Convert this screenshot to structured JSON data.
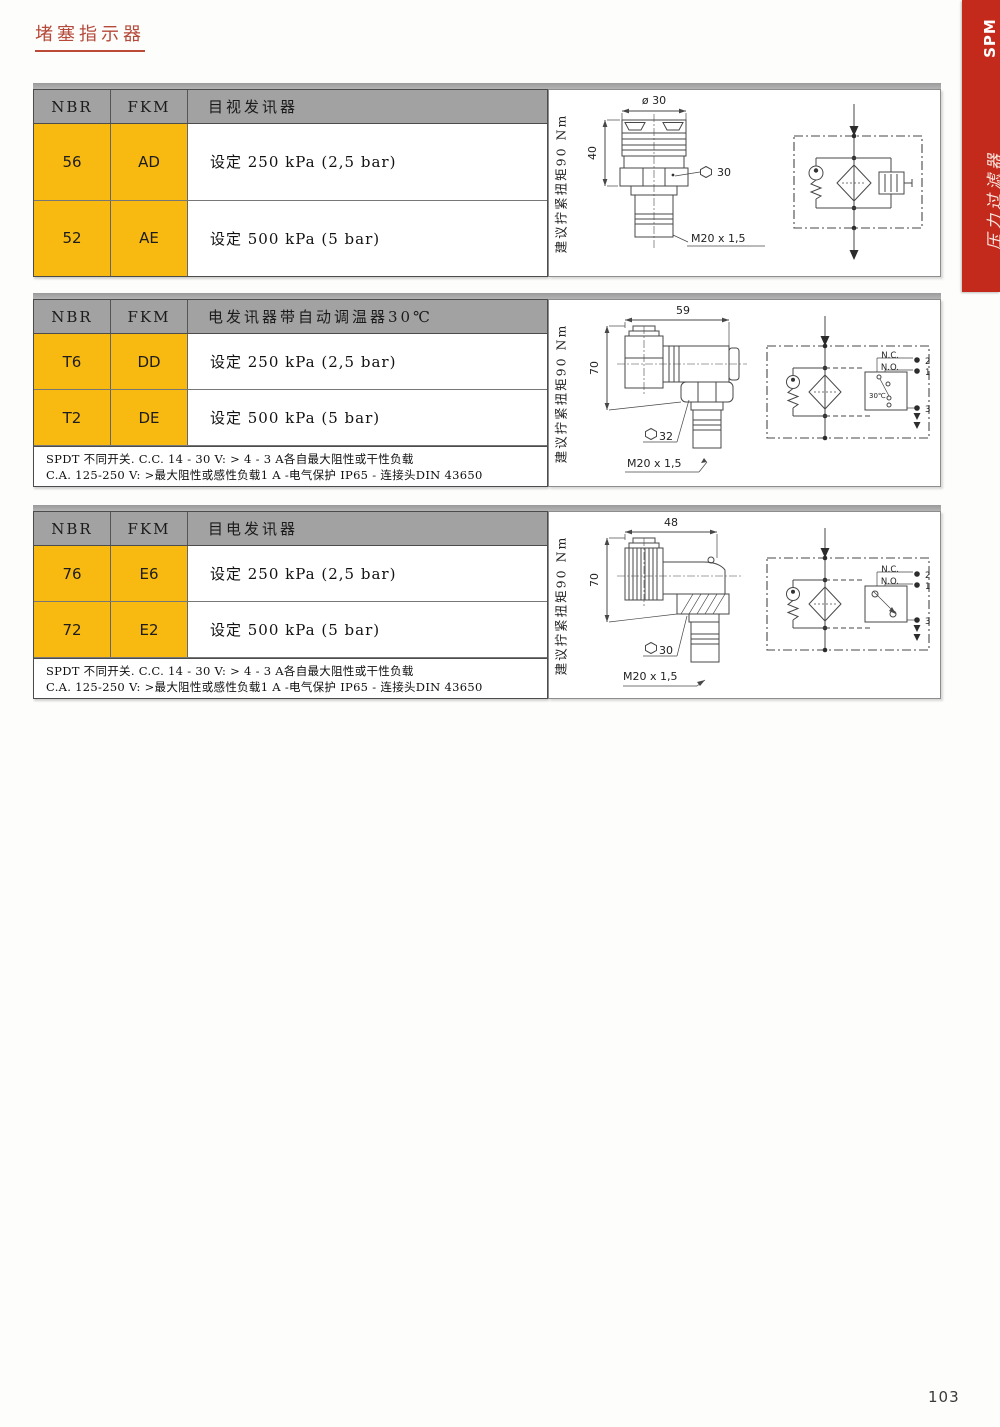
{
  "page": {
    "title": "堵塞指示器",
    "page_number": "103"
  },
  "sidebar": {
    "series": "SPM",
    "category": "压力过滤器"
  },
  "colors": {
    "accent_red": "#c42a1c",
    "cell_orange": "#f8ba10",
    "header_gray": "#a2a2a2"
  },
  "sections": [
    {
      "header": {
        "nbr": "NBR",
        "fkm": "FKM",
        "title": "目视发讯器"
      },
      "rows": [
        {
          "nbr": "56",
          "fkm": "AD",
          "desc": "设定 250 kPa (2,5 bar)"
        },
        {
          "nbr": "52",
          "fkm": "AE",
          "desc": "设定 500 kPa (5 bar)"
        }
      ],
      "torque_note": "建议拧紧扭矩90 Nm",
      "drawing": {
        "dia_top": "ø 30",
        "height": "40",
        "hex": "30",
        "thread": "M20 x 1,5"
      }
    },
    {
      "header": {
        "nbr": "NBR",
        "fkm": "FKM",
        "title": "电发讯器带自动调温器30℃"
      },
      "rows": [
        {
          "nbr": "T6",
          "fkm": "DD",
          "desc": "设定 250 kPa (2,5 bar)"
        },
        {
          "nbr": "T2",
          "fkm": "DE",
          "desc": "设定 500 kPa (5 bar)"
        }
      ],
      "footnote": {
        "line1": "SPDT 不同开关. C.C. 14 - 30 V: > 4 - 3 A各自最大阻性或干性负载",
        "line2": "C.A. 125-250 V: >最大阻性或感性负载1 A -电气保护 IP65 - 连接头DIN 43650"
      },
      "torque_note": "建议拧紧扭矩90 Nm",
      "drawing": {
        "width_top": "59",
        "height": "70",
        "hex": "32",
        "thread": "M20 x 1,5",
        "thermostat": "30℃",
        "nc": "N.C.",
        "no": "N.O.",
        "t1": "1",
        "t2": "2",
        "t3": "3"
      }
    },
    {
      "header": {
        "nbr": "NBR",
        "fkm": "FKM",
        "title": "目电发讯器"
      },
      "rows": [
        {
          "nbr": "76",
          "fkm": "E6",
          "desc": "设定 250 kPa (2,5 bar)"
        },
        {
          "nbr": "72",
          "fkm": "E2",
          "desc": "设定 500 kPa (5 bar)"
        }
      ],
      "footnote": {
        "line1": "SPDT 不同开关. C.C. 14 - 30 V: > 4 - 3 A各自最大阻性或干性负载",
        "line2": "C.A. 125-250 V: >最大阻性或感性负载1 A -电气保护 IP65 - 连接头DIN 43650"
      },
      "torque_note": "建议拧紧扭矩90 Nm",
      "drawing": {
        "width_top": "48",
        "height": "70",
        "hex": "30",
        "thread": "M20 x 1,5",
        "nc": "N.C.",
        "no": "N.O.",
        "t1": "1",
        "t2": "2",
        "t3": "3"
      }
    }
  ]
}
